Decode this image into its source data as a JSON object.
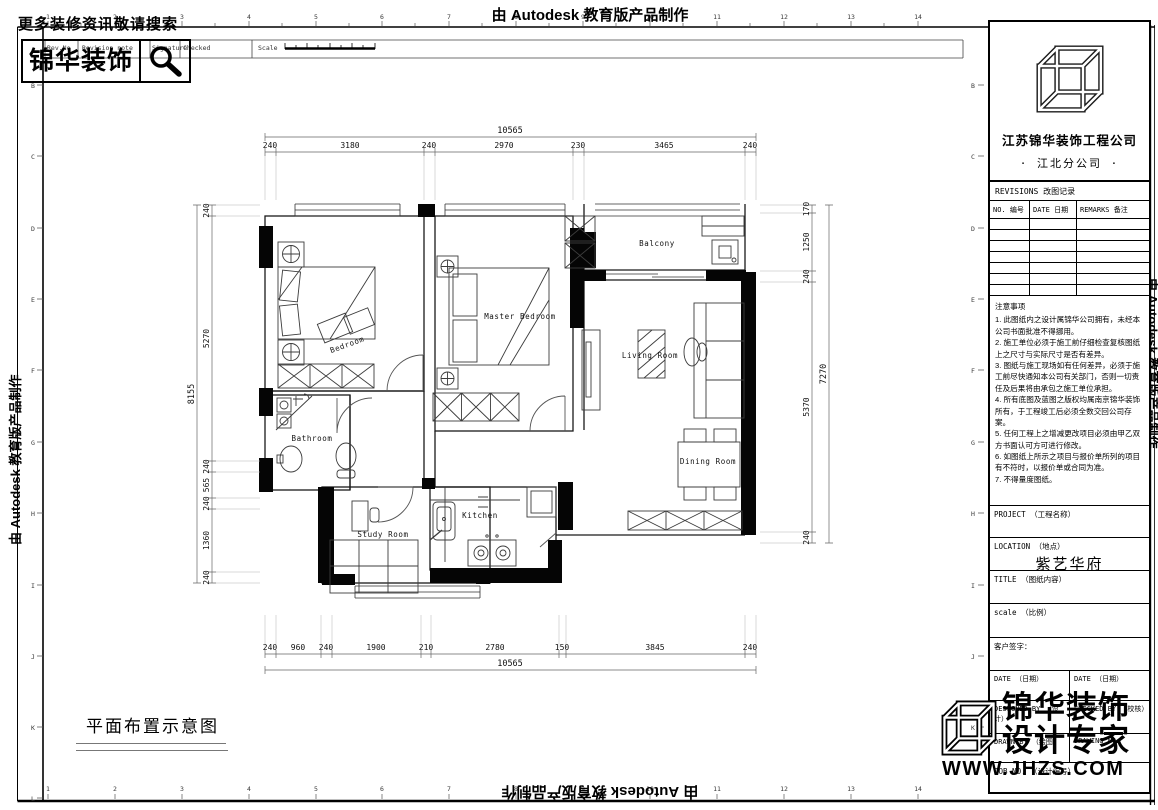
{
  "header": {
    "tagline": "更多装修资讯敬请搜索",
    "brand": "锦华装饰",
    "autodesk_note": "由 Autodesk 教育版产品制作"
  },
  "revision_strip": {
    "rev_no": "Rev.No",
    "revision_note": "Revision note",
    "signature": "Signature",
    "checked": "Checked",
    "scale": "Scale"
  },
  "grid": {
    "cols": [
      "1",
      "2",
      "3",
      "4",
      "5",
      "6",
      "7",
      "8",
      "9",
      "10",
      "11",
      "12",
      "13",
      "14"
    ],
    "rows": [
      "B",
      "C",
      "D",
      "E",
      "F",
      "G",
      "H",
      "I",
      "J",
      "K",
      "L"
    ]
  },
  "plan": {
    "caption": "平面布置示意图",
    "rooms": {
      "bedroom": "Bedroom",
      "master_bedroom": "Master Bedroom",
      "balcony": "Balcony",
      "living_room": "Living Room",
      "bathroom": "Bathroom",
      "dining_room": "Dining Room",
      "kitchen": "Kitchen",
      "study_room": "Study Room"
    },
    "dims": {
      "top_total": "10565",
      "top": [
        "240",
        "3180",
        "240",
        "2970",
        "230",
        "3465",
        "240"
      ],
      "bottom": [
        "240",
        "960",
        "240",
        "1900",
        "210",
        "2780",
        "150",
        "3845",
        "240"
      ],
      "bottom_total": "10565",
      "left_total": "8155",
      "left": [
        "240",
        "5270",
        "240",
        "565",
        "240",
        "1360",
        "240"
      ],
      "right": [
        "170",
        "1250",
        "240",
        "5370",
        "240"
      ],
      "right_total": "7270"
    }
  },
  "title_block": {
    "company": "江苏锦华装饰工程公司",
    "branch": "· 江北分公司 ·",
    "revisions_title": "REVISIONS 改图记录",
    "rev_cols": [
      "NO. 编号",
      "DATE 日期",
      "REMARKS 备注"
    ],
    "notes_title": "注意事项",
    "notes": [
      "1. 此图纸内之设计属锦华公司拥有，未经本公司书面批准不得挪用。",
      "2. 施工单位必须于施工前仔细检查复核图纸上之尺寸与实际尺寸是否有差异。",
      "3. 图纸与施工现场如有任何差异，必须于施工前尽快通知本公司有关部门，否则一切责任及后果将由承包之施工单位承担。",
      "4. 所有底图及蓝图之版权均属南京锦华装饰所有，于工程竣工后必须全数交回公司存案。",
      "5. 任何工程上之增减更改项目必须由甲乙双方书面认可方可进行修改。",
      "6. 如图纸上所示之项目与报价单所列的项目有不符时，以报价单或合同为准。",
      "7. 不得量度图纸。"
    ],
    "project_label": "PROJECT （工程名称）",
    "location_label": "LOCATION （地点）",
    "location_value": "紫艺华府",
    "title_label": "TITLE （图纸内容）",
    "scale_label": "scale （比例）",
    "client_sign_label": "客户签字：",
    "date_label": "DATE （日期）",
    "date_label2": "DATE （日期）",
    "designed_by": "DESIGNED BY （设计）",
    "checked_by": "CHECKED BY （校核）",
    "drawn_by": "DRAWN BY （绘图）",
    "drawing_no": "DRAWING NO.",
    "job_no": "JOB NO. （设计编号）"
  },
  "watermark": {
    "line1": "锦华装饰",
    "line2": "设计专家",
    "url": "WWW.JHZS.COM"
  },
  "colors": {
    "ink": "#000000",
    "wall_fill": "#050505",
    "dim_line": "#777777"
  }
}
